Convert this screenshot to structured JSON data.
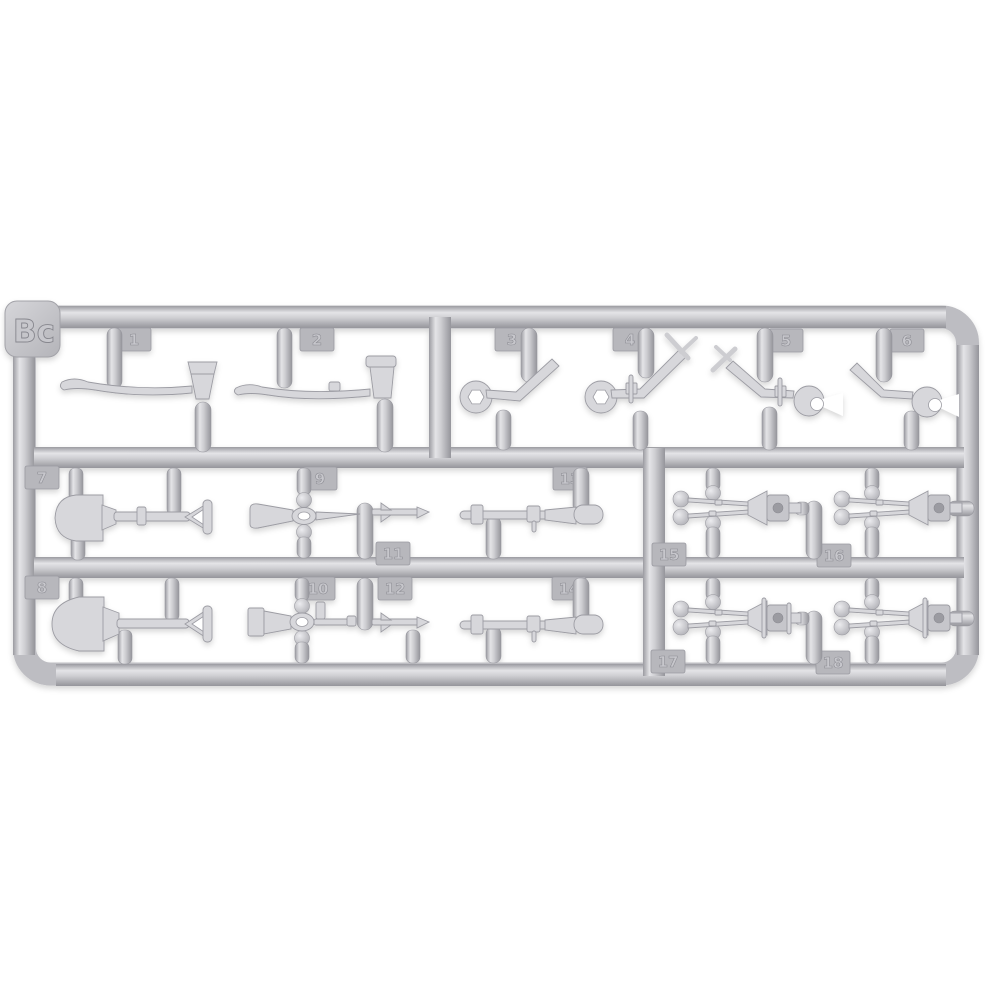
{
  "sprue": {
    "code": "Bc",
    "plastic_color": "#c6c6ca",
    "highlight_color": "#e8e8eb",
    "shadow_color": "#97979e",
    "background_color": "#ffffff",
    "tabs": [
      {
        "label": "1"
      },
      {
        "label": "2"
      },
      {
        "label": "3"
      },
      {
        "label": "4"
      },
      {
        "label": "5"
      },
      {
        "label": "6"
      },
      {
        "label": "7"
      },
      {
        "label": "8"
      },
      {
        "label": "9"
      },
      {
        "label": "10"
      },
      {
        "label": "11"
      },
      {
        "label": "12"
      },
      {
        "label": "13"
      },
      {
        "label": "14"
      },
      {
        "label": "15"
      },
      {
        "label": "16"
      },
      {
        "label": "17"
      },
      {
        "label": "18"
      }
    ]
  }
}
